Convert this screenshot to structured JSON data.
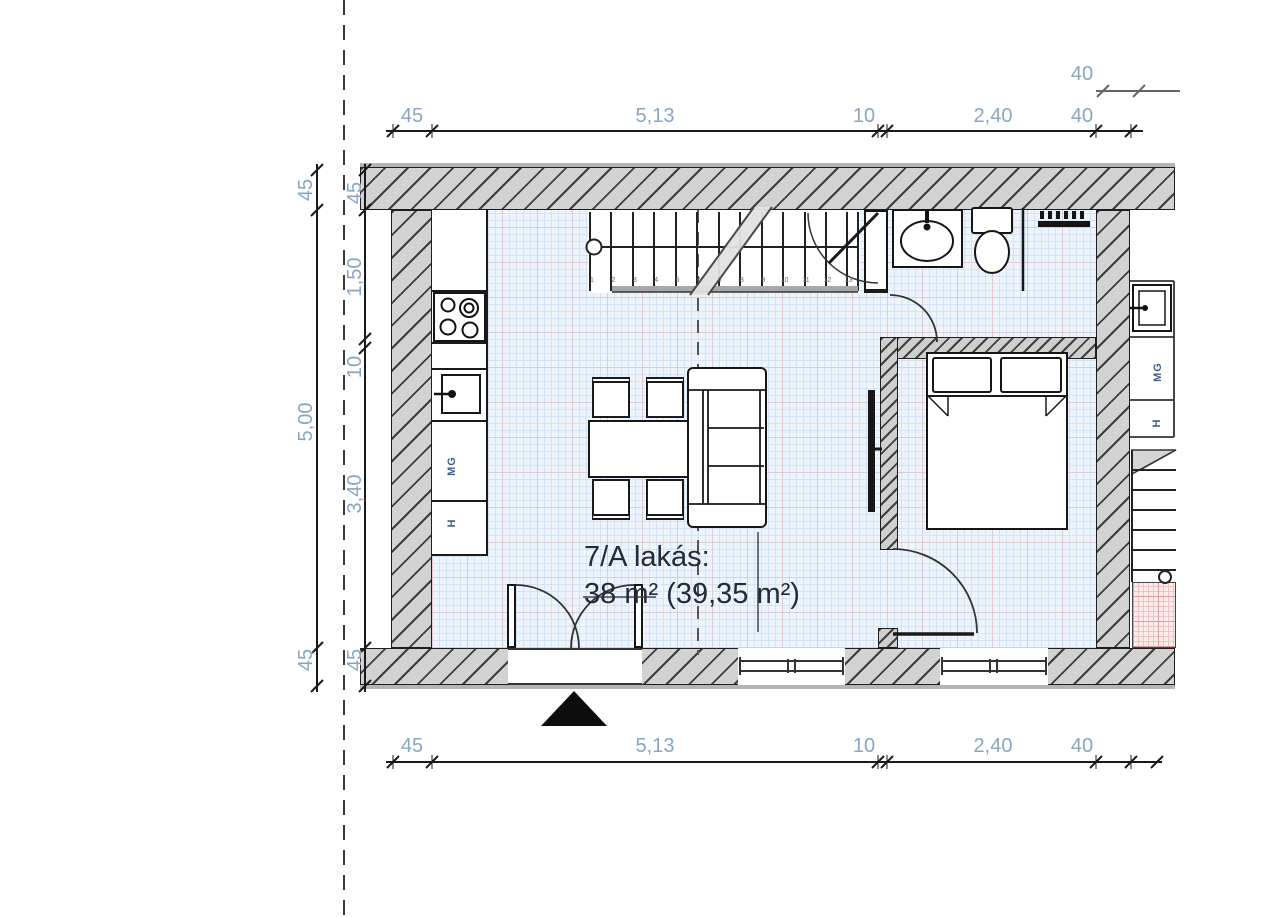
{
  "unit": {
    "name_line": "7/A lakás:",
    "area_line": "38 m² (39,35 m²)"
  },
  "dimensions": {
    "top": [
      "45",
      "5,13",
      "10",
      "2,40",
      "40"
    ],
    "top_offset": "40",
    "bottom": [
      "45",
      "5,13",
      "10",
      "2,40",
      "40"
    ],
    "left_outer": [
      "45",
      "5,00",
      "45"
    ],
    "left_inner": [
      "45",
      "1,50",
      "10",
      "3,40",
      "45"
    ]
  },
  "kitchen": {
    "dishwasher_label": "MG",
    "fridge_label": "H"
  },
  "neighbor": {
    "dishwasher_label": "MG",
    "fridge_label": "H"
  },
  "stairs": {
    "step_numbers": [
      "1",
      "2",
      "3",
      "4",
      "5",
      "6",
      "7",
      "8",
      "9",
      "10",
      "11",
      "12",
      "13"
    ]
  },
  "colors": {
    "floor": "#edf4fc",
    "wall": "#d2d2d2",
    "shower_floor": "#fcecec",
    "dimension_text": "#8aa5c3",
    "label_text": "#242a39"
  }
}
